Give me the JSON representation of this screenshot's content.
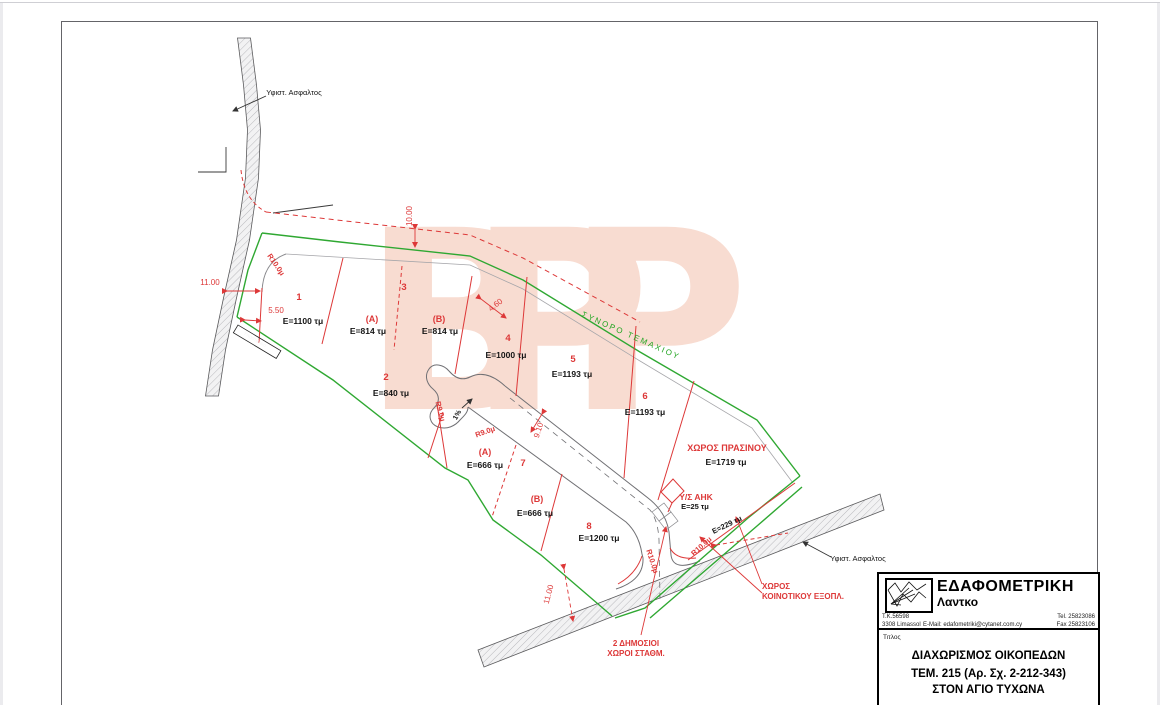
{
  "colors": {
    "line_red": "#dd3838",
    "boundary_green": "#2fa832",
    "watermark_pink": "#f8dcd1",
    "road_outline": "#5a5a5c"
  },
  "watermark": {
    "text": "BPP"
  },
  "plan": {
    "labels": {
      "asphalt_top": "Υφιστ. Ασφαλτος",
      "asphalt_bottom": "Υφιστ. Ασφαλτος",
      "side_structure": "Υποστατικο",
      "parcel_boundary": "ΣΥΝΟΡΟ ΤΕΜΑΧΙΟΥ"
    },
    "plots": {
      "p1": {
        "num": "1",
        "area": "E=1100 τμ"
      },
      "p2": {
        "num": "2",
        "area": "E=840 τμ"
      },
      "p3": {
        "num": "3"
      },
      "p3a": {
        "num": "(A)",
        "area": "E=814 τμ"
      },
      "p3b": {
        "num": "(B)",
        "area": "E=814 τμ"
      },
      "p4": {
        "num": "4",
        "area": "E=1000 τμ"
      },
      "p5": {
        "num": "5",
        "area": "E=1193 τμ"
      },
      "p6": {
        "num": "6",
        "area": "E=1193 τμ"
      },
      "p7": {
        "num": "7"
      },
      "p7a": {
        "num": "(A)",
        "area": "E=666 τμ"
      },
      "p7b": {
        "num": "(B)",
        "area": "E=666 τμ"
      },
      "p8": {
        "num": "8",
        "area": "E=1200 τμ"
      }
    },
    "zones": {
      "green_space": {
        "name": "ΧΩΡΟΣ ΠΡΑΣΙΝΟΥ",
        "area": "E=1719 τμ"
      },
      "substation": {
        "name": "Υ/Σ ΑΗΚ",
        "area": "E=25 τμ"
      },
      "road_strip": {
        "area": "E=229 τμ"
      },
      "community": {
        "line1": "ΧΩΡΟΣ",
        "line2": "ΚΟΙΝΟΤΙΚΟΥ ΕΞΟΠΛ."
      },
      "parking": {
        "line1": "2 ΔΗΜΟΣΙΟΙ",
        "line2": "ΧΩΡΟΙ ΣΤΑΘΜ."
      }
    },
    "dimensions": {
      "offset_top": "10.00",
      "width_left": "11.00",
      "half_left": "5.50",
      "gap": "4.60",
      "road_width": "9.10",
      "offset_bottom": "11.00",
      "radius10": "R10.0μ",
      "radius9": "R9.0μ",
      "grade": "1%"
    }
  },
  "title_block": {
    "company": "ΕΔΑΦΟΜΕΤΡΙΚΗ",
    "company_sub": "Λαντκο",
    "po_box": "Τ.Κ.56598",
    "city": "3308 Limassol",
    "email": "E-Mail: edafometriki@cytanet.com.cy",
    "tel": "Tel. 25823086",
    "fax": "Fax 25823106",
    "title_label": "Τιτλος",
    "title_line1": "ΔΙΑΧΩΡΙΣΜΟΣ ΟΙΚΟΠΕΔΩΝ",
    "title_line2": "ΤΕΜ. 215 (Αρ. Σχ. 2-212-343)",
    "title_line3": "ΣΤΟΝ ΑΓΙΟ ΤΥΧΩΝΑ"
  }
}
